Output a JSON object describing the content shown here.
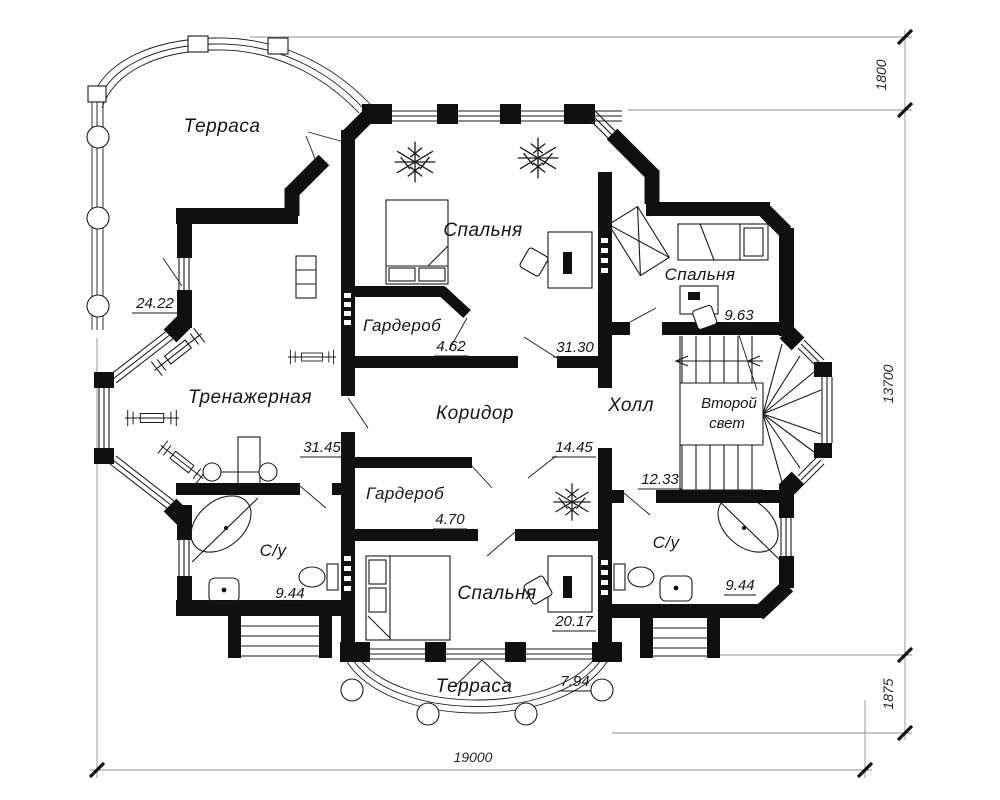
{
  "rooms": {
    "terrace_top": {
      "label": "Терраса",
      "area": "24.22"
    },
    "bedroom_top": {
      "label": "Спальня",
      "area": "31.30"
    },
    "wardrobe_top": {
      "label": "Гардероб",
      "area": "4.62"
    },
    "bedroom_right": {
      "label": "Спальня",
      "area": "9.63"
    },
    "gym": {
      "label": "Тренажерная",
      "area": "31.45"
    },
    "corridor": {
      "label": "Коридор",
      "area": "14.45"
    },
    "hall": {
      "label": "Холл",
      "area": "12.33"
    },
    "void": {
      "line1": "Второй",
      "line2": "свет"
    },
    "wardrobe_bottom": {
      "label": "Гардероб",
      "area": "4.70"
    },
    "bedroom_bottom": {
      "label": "Спальня",
      "area": "20.17"
    },
    "bath_left": {
      "label": "С/у",
      "area": "9.44"
    },
    "bath_right": {
      "label": "С/у",
      "area": "9.44"
    },
    "terrace_bottom": {
      "label": "Терраса",
      "area": "7.94"
    }
  },
  "dims": {
    "overall_width": "19000",
    "overall_height": "13700",
    "offset_top": "1800",
    "offset_bottom": "1875"
  }
}
